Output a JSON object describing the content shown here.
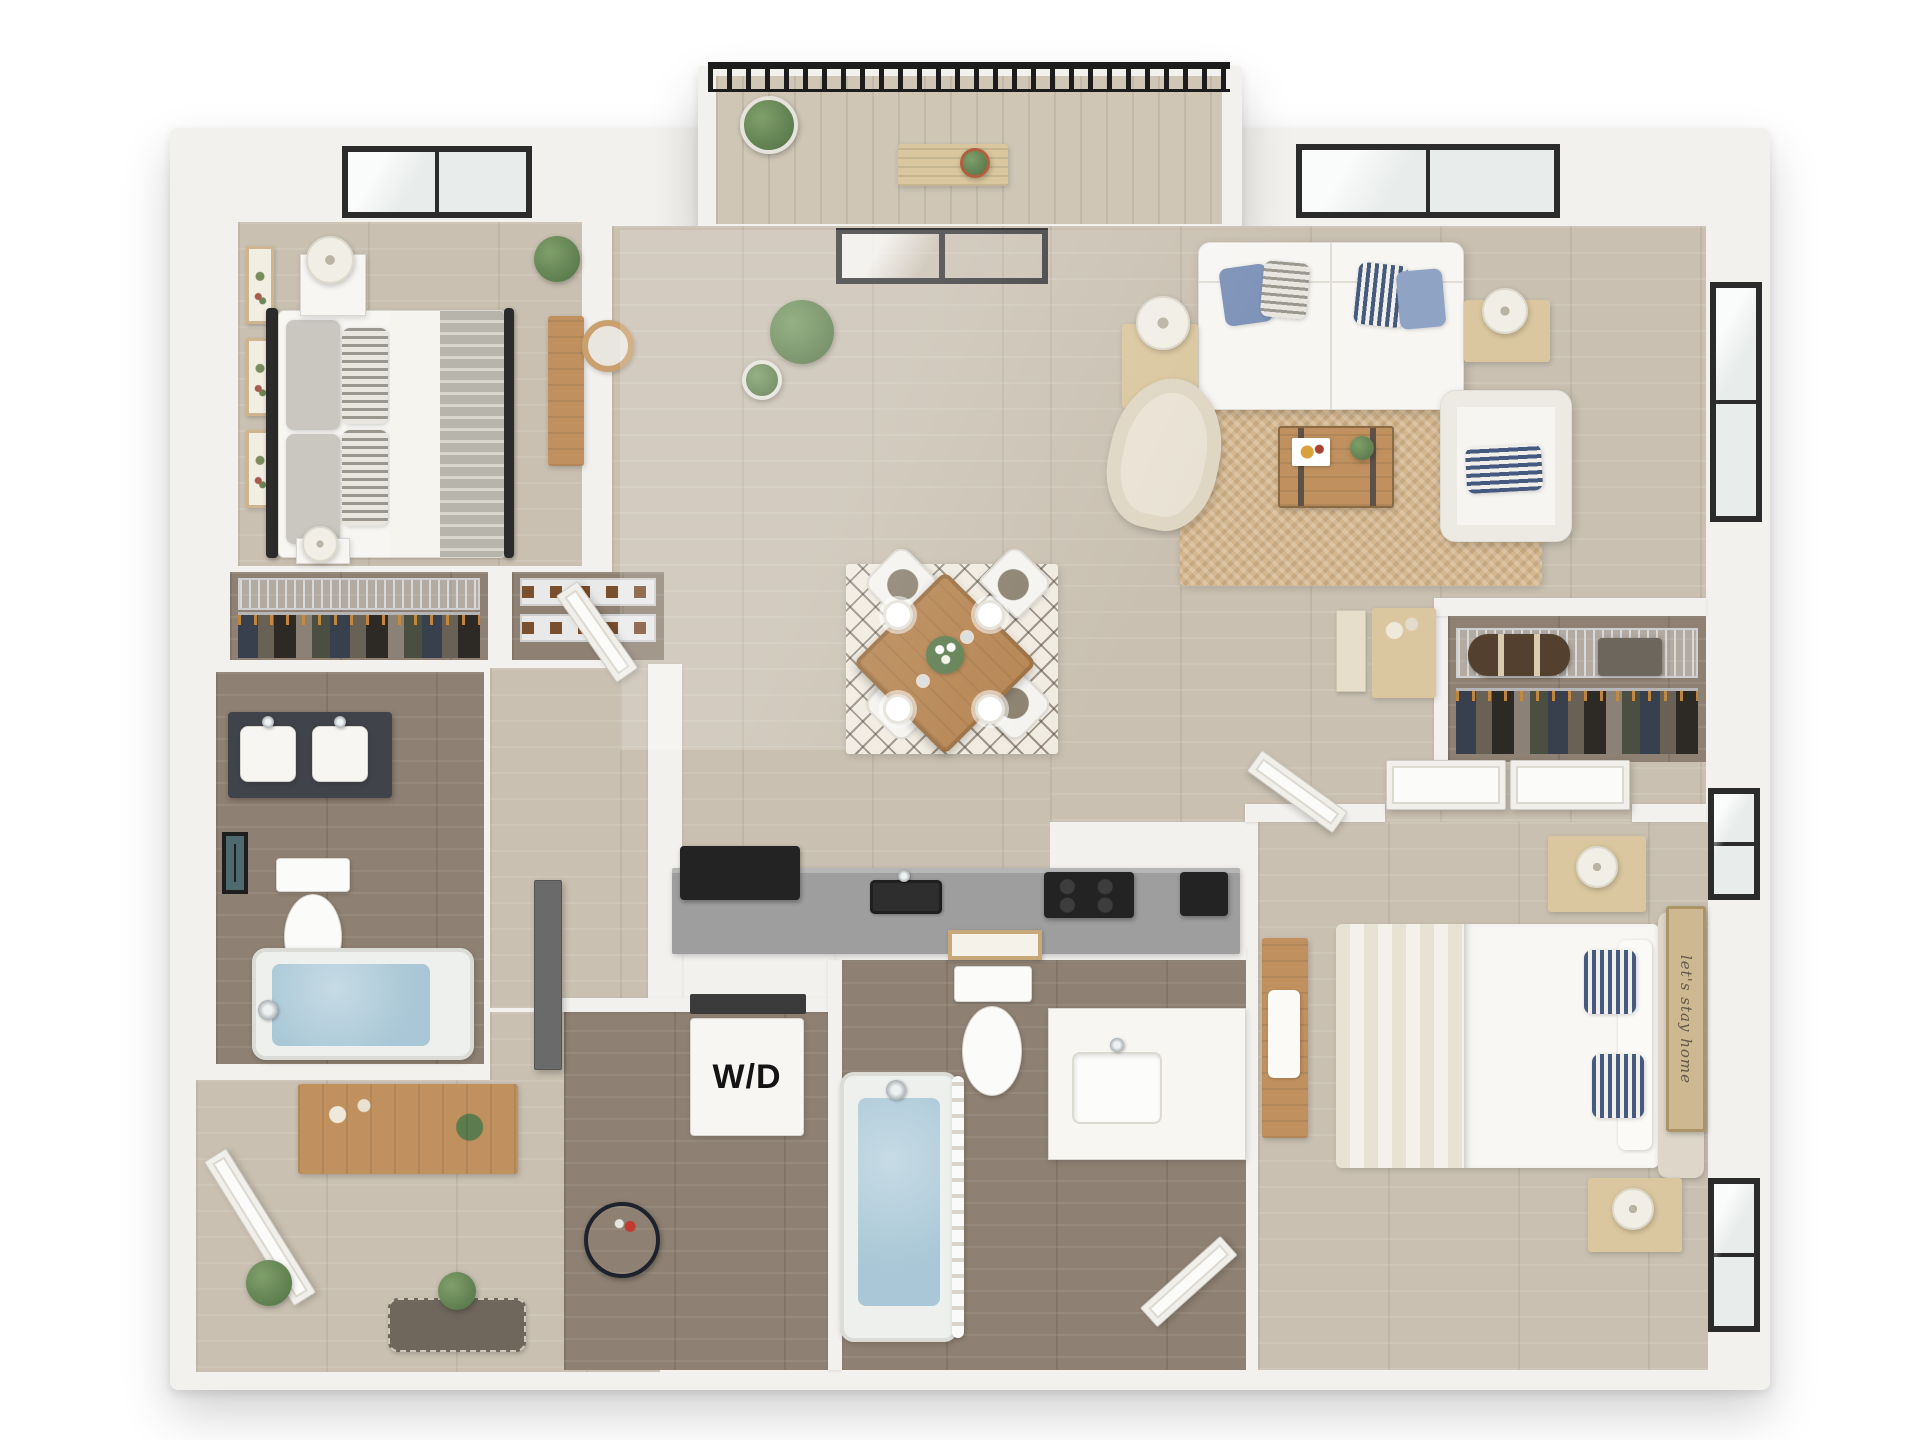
{
  "labels": {
    "washer_dryer": "W/D",
    "wall_sign": "let's stay home"
  },
  "colors": {
    "wall": "#f3f1ee",
    "floor_light": "#c9c0b1",
    "floor_dark": "#8e8173",
    "counter": "#9e9e9e",
    "appliance": "#232323",
    "water": "#a9c7d6",
    "rug_jute": "#d4b78f",
    "rug_cream": "#f0ebe0",
    "wood": "#c0915f",
    "wood_light": "#dac79f",
    "greenery": "#5d7c4e",
    "pillow_blue": "#7d92b8",
    "pillow_blue_light": "#8fa3c4",
    "navy": "#46597e",
    "railing": "#1c1c1c",
    "fixture_white": "#f7f6f3",
    "headboard": "#ded7c9",
    "bath_cabinet": "#41434a"
  }
}
